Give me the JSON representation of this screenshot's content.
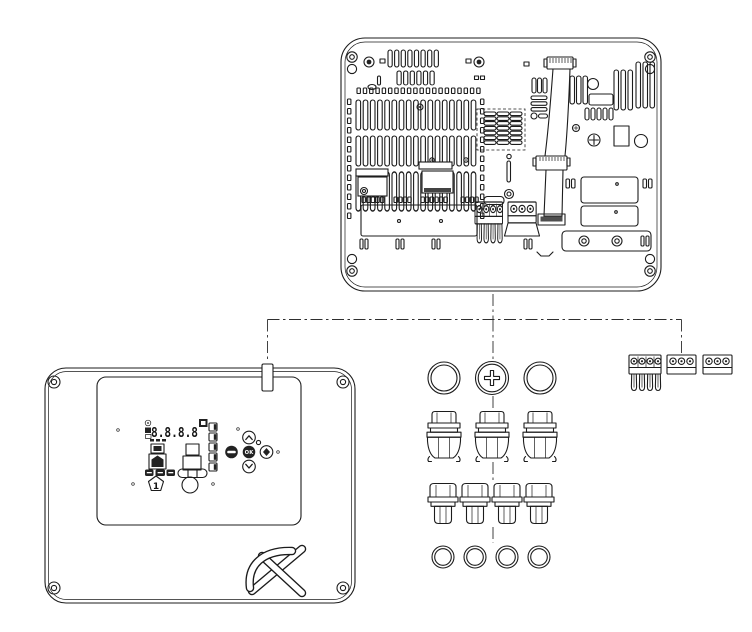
{
  "canvas": {
    "width": 752,
    "height": 632,
    "background": "#ffffff",
    "line_color": "#1c1c1c",
    "dark_fill": "#222222"
  },
  "figure": {
    "type": "exploded-assembly-technical-drawing",
    "parts": [
      {
        "id": "rear-housing",
        "label": "rear housing with PCB, ventilation slots, ribbon cable and terminal blocks"
      },
      {
        "id": "front-cover",
        "label": "front cover with display label, keypad and logo"
      },
      {
        "id": "blanking-plugs",
        "label": "round blanking plugs, middle one with cross-slot screw"
      },
      {
        "id": "large-cable-glands",
        "label": "three large cable glands"
      },
      {
        "id": "small-cable-glands",
        "label": "four small cable glands"
      },
      {
        "id": "lock-nuts",
        "label": "four lock-nut rings"
      },
      {
        "id": "terminal-plugs",
        "label": "4-pole plug with crimped pins and two 3-pole terminal plugs"
      }
    ]
  },
  "front_cover": {
    "display": {
      "digits": "8.8.8.8",
      "priority_number": "1"
    },
    "keypad": {
      "ok_label": "OK"
    }
  }
}
